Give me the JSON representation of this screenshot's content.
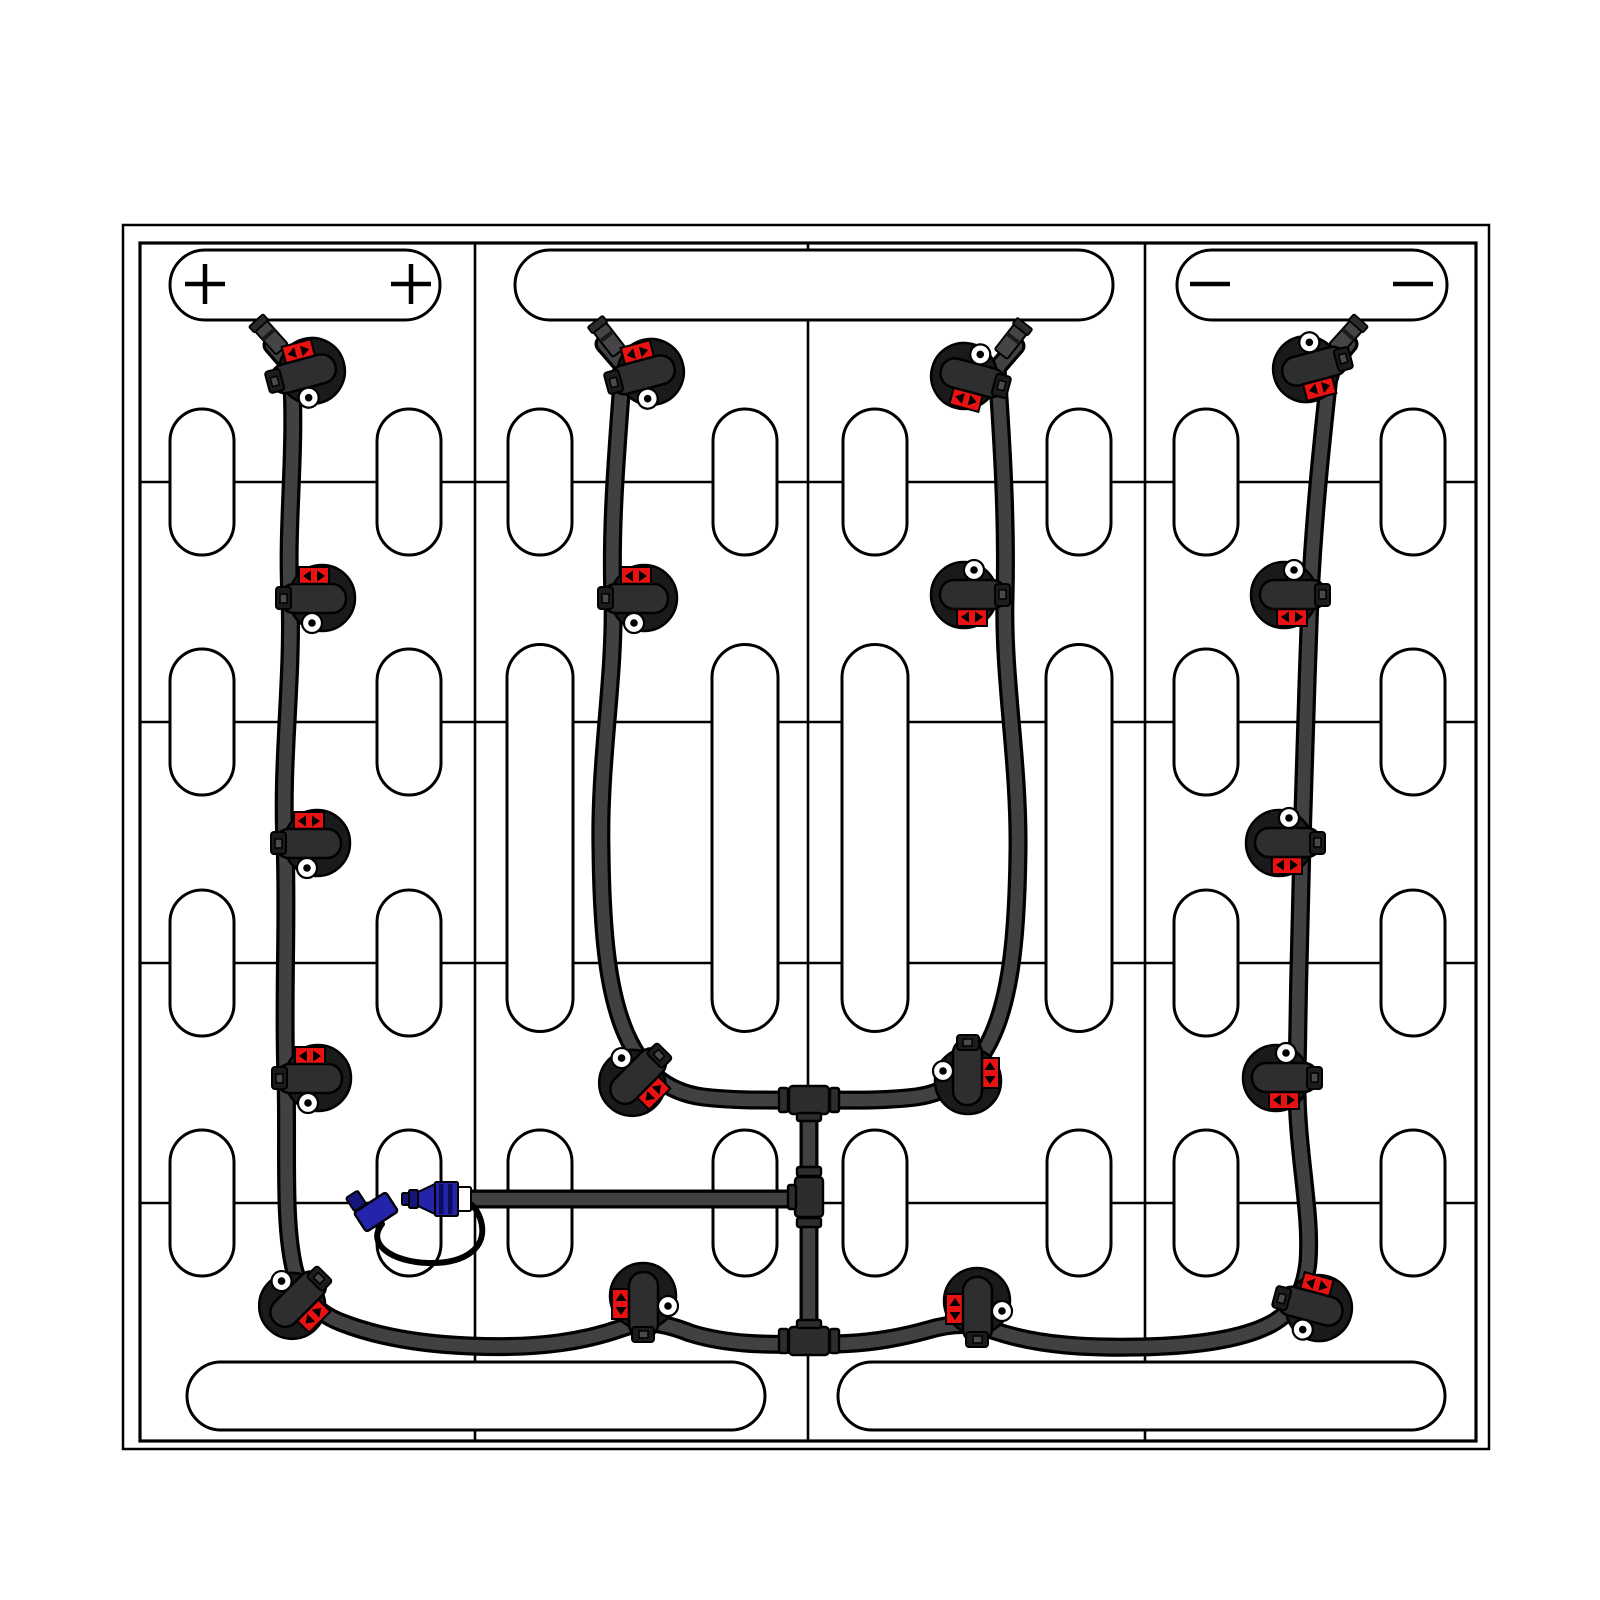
{
  "diagram": {
    "kind": "battery-watering-system-top-view",
    "canvas": {
      "w": 1600,
      "h": 1600,
      "background": "#ffffff"
    },
    "colors": {
      "line": "#000000",
      "tube_outline": "#000000",
      "tube_core": "#414143",
      "valve_dark": "#1a1a1a",
      "valve_body": "#2e2e30",
      "tee_fill": "#2d2d2f",
      "badge_red": "#e81212",
      "coupler_blue": "#2424aa",
      "coupler_dark_blue": "#15157a",
      "white": "#ffffff"
    },
    "tray": {
      "outer": {
        "x": 123,
        "y": 225,
        "w": 1366,
        "h": 1224,
        "stroke_w": 2.5
      },
      "inner": {
        "x": 140,
        "y": 243,
        "w": 1336,
        "h": 1198,
        "stroke_w": 3.2
      }
    },
    "grid": {
      "dividers_x": [
        475,
        808,
        1145
      ],
      "row_lines_y": [
        482,
        722,
        963,
        1203
      ],
      "top": 243,
      "bottom": 1441,
      "left": 140,
      "right": 1476,
      "stroke_w": 2.6
    },
    "terminals": [
      {
        "id": "positive",
        "x": 170,
        "y": 250,
        "w": 270,
        "h": 70,
        "symbol": "+",
        "symbol_x": [
          205,
          411
        ],
        "symbol_y": 284
      },
      {
        "id": "blank",
        "x": 515,
        "y": 250,
        "w": 598,
        "h": 70,
        "symbol": "",
        "symbol_x": [],
        "symbol_y": 284
      },
      {
        "id": "negative",
        "x": 1177,
        "y": 250,
        "w": 270,
        "h": 70,
        "symbol": "-",
        "symbol_x": [
          1210,
          1413
        ],
        "symbol_y": 284
      }
    ],
    "bottom_plates": [
      {
        "x": 187,
        "y": 1362,
        "w": 578,
        "h": 68
      },
      {
        "x": 838,
        "y": 1362,
        "w": 607,
        "h": 68
      }
    ],
    "cell_pills": {
      "short": {
        "w": 64,
        "h": 146,
        "rx": 32
      },
      "long": {
        "w": 66,
        "h": 387,
        "rx": 33
      },
      "items": [
        {
          "cx": 202,
          "cy": 482,
          "kind": "short"
        },
        {
          "cx": 409,
          "cy": 482,
          "kind": "short"
        },
        {
          "cx": 202,
          "cy": 722,
          "kind": "short"
        },
        {
          "cx": 409,
          "cy": 722,
          "kind": "short"
        },
        {
          "cx": 202,
          "cy": 963,
          "kind": "short"
        },
        {
          "cx": 409,
          "cy": 963,
          "kind": "short"
        },
        {
          "cx": 202,
          "cy": 1203,
          "kind": "short"
        },
        {
          "cx": 409,
          "cy": 1203,
          "kind": "short"
        },
        {
          "cx": 540,
          "cy": 482,
          "kind": "short"
        },
        {
          "cx": 745,
          "cy": 482,
          "kind": "short"
        },
        {
          "cx": 540,
          "cy": 838,
          "kind": "long"
        },
        {
          "cx": 745,
          "cy": 838,
          "kind": "long"
        },
        {
          "cx": 540,
          "cy": 1203,
          "kind": "short"
        },
        {
          "cx": 745,
          "cy": 1203,
          "kind": "short"
        },
        {
          "cx": 875,
          "cy": 482,
          "kind": "short"
        },
        {
          "cx": 1079,
          "cy": 482,
          "kind": "short"
        },
        {
          "cx": 875,
          "cy": 838,
          "kind": "long"
        },
        {
          "cx": 1079,
          "cy": 838,
          "kind": "long"
        },
        {
          "cx": 875,
          "cy": 1203,
          "kind": "short"
        },
        {
          "cx": 1079,
          "cy": 1203,
          "kind": "short"
        },
        {
          "cx": 1206,
          "cy": 482,
          "kind": "short"
        },
        {
          "cx": 1413,
          "cy": 482,
          "kind": "short"
        },
        {
          "cx": 1206,
          "cy": 722,
          "kind": "short"
        },
        {
          "cx": 1413,
          "cy": 722,
          "kind": "short"
        },
        {
          "cx": 1206,
          "cy": 963,
          "kind": "short"
        },
        {
          "cx": 1413,
          "cy": 963,
          "kind": "short"
        },
        {
          "cx": 1206,
          "cy": 1203,
          "kind": "short"
        },
        {
          "cx": 1413,
          "cy": 1203,
          "kind": "short"
        }
      ]
    },
    "tubes": {
      "outline_w": 19,
      "core_w": 12.5,
      "paths": [
        {
          "id": "tube-main-loop",
          "d": "M 272,345 L 291,367 C 297,450 286,520 290,598 C 293,680 281,760 285,843 C 288,920 283,1000 286,1078 C 288,1150 283,1220 294,1268 C 301,1295 315,1312 340,1322 C 375,1336 420,1344 470,1346 C 540,1349 585,1341 622,1328 C 645,1320 662,1322 690,1333 C 728,1345 770,1345 809,1344 C 850,1345 885,1342 928,1330 C 952,1323 972,1322 995,1331 C 1040,1346 1090,1348 1140,1347 C 1195,1346 1243,1339 1271,1324 C 1295,1311 1305,1290 1308,1262 C 1312,1210 1296,1150 1297,1078 C 1298,1000 1300,920 1302,843 C 1304,770 1307,680 1310,598 C 1314,515 1322,440 1330,367 L 1349,344"
        },
        {
          "id": "tube-col2-branch",
          "d": "M 604,344 L 623,366 C 618,440 610,520 613,598 C 615,680 599,760 601,850 C 602,940 609,995 626,1034 C 642,1070 665,1092 703,1097 C 737,1101 772,1100 812,1100"
        },
        {
          "id": "tube-col3-branch",
          "d": "M 1016,346 L 997,368 C 1002,440 1007,520 1005,598 C 1003,680 1019,760 1018,850 C 1017,940 1010,995 993,1034 C 977,1070 953,1092 916,1097 C 884,1101 850,1100 806,1100"
        },
        {
          "id": "tube-manifold-spine",
          "d": "M 809,1100 L 809,1342"
        },
        {
          "id": "tube-fill-line",
          "d": "M 472,1199 L 809,1199"
        }
      ]
    },
    "tees": [
      {
        "x": 809,
        "y": 1100,
        "main": "h",
        "branch": "S"
      },
      {
        "x": 809,
        "y": 1197,
        "main": "v",
        "branch": "W"
      },
      {
        "x": 809,
        "y": 1341,
        "main": "h",
        "branch": "N"
      }
    ],
    "end_caps": [
      {
        "x": 270,
        "y": 336,
        "rot": -42
      },
      {
        "x": 608,
        "y": 338,
        "rot": -38
      },
      {
        "x": 1012,
        "y": 340,
        "rot": 38
      },
      {
        "x": 1347,
        "y": 336,
        "rot": 42
      }
    ],
    "valves": [
      {
        "x": 308,
        "y": 372,
        "rot": -15
      },
      {
        "x": 318,
        "y": 598,
        "rot": 0
      },
      {
        "x": 313,
        "y": 843,
        "rot": 0
      },
      {
        "x": 314,
        "y": 1078,
        "rot": 0
      },
      {
        "x": 295,
        "y": 1303,
        "rot": 135
      },
      {
        "x": 647,
        "y": 373,
        "rot": -15
      },
      {
        "x": 640,
        "y": 598,
        "rot": 0
      },
      {
        "x": 635,
        "y": 1080,
        "rot": 135
      },
      {
        "x": 643,
        "y": 1300,
        "rot": -90
      },
      {
        "x": 968,
        "y": 377,
        "rot": 195
      },
      {
        "x": 968,
        "y": 595,
        "rot": 180
      },
      {
        "x": 968,
        "y": 1077,
        "rot": 90
      },
      {
        "x": 977,
        "y": 1305,
        "rot": -90
      },
      {
        "x": 1310,
        "y": 368,
        "rot": 165
      },
      {
        "x": 1288,
        "y": 595,
        "rot": 180
      },
      {
        "x": 1283,
        "y": 843,
        "rot": 180
      },
      {
        "x": 1280,
        "y": 1078,
        "rot": 180
      },
      {
        "x": 1315,
        "y": 1307,
        "rot": 15
      }
    ],
    "coupler": {
      "y_center": 1199,
      "segments": [
        {
          "x": 402,
          "y": 1193,
          "w": 7,
          "h": 12,
          "fill": "dark"
        },
        {
          "x": 409,
          "y": 1190,
          "w": 9,
          "h": 18,
          "fill": "dark"
        },
        {
          "x": 418,
          "y": 1188,
          "w": 17,
          "h": 22,
          "fill": "blue",
          "cone": true
        },
        {
          "x": 435,
          "y": 1182,
          "w": 23,
          "h": 34,
          "fill": "blue",
          "stripes": true
        },
        {
          "x": 458,
          "y": 1187,
          "w": 13,
          "h": 24,
          "fill": "white"
        }
      ],
      "dust_cap": {
        "cx": 376,
        "cy": 1212,
        "w": 38,
        "h": 23,
        "rot": -33
      },
      "cap_tip": {
        "cx": 356,
        "cy": 1201,
        "w": 14,
        "h": 16,
        "rot": -33
      },
      "tether_d": "M 382,1224 C 366,1244 392,1262 428,1263 C 466,1264 488,1247 481,1221 C 478,1211 474,1206 469,1203"
    }
  }
}
